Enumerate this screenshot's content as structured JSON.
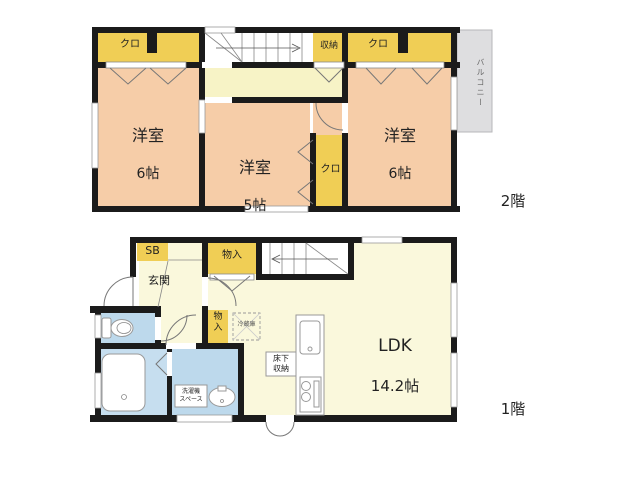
{
  "floor2": {
    "label": "2階",
    "room_left": {
      "name": "洋室",
      "size": "6帖"
    },
    "room_mid": {
      "name": "洋室",
      "size": "5帖"
    },
    "room_right": {
      "name": "洋室",
      "size": "6帖"
    },
    "closet_left": "クロ",
    "closet_mid": "クロ",
    "closet_right": "クロ",
    "storage": "収納",
    "balcony": "バルコニー"
  },
  "floor1": {
    "label": "1階",
    "ldk": {
      "name": "LDK",
      "size": "14.2帖"
    },
    "entrance": "玄関",
    "shoe_box": "SB",
    "storage_top": "物入",
    "storage_side": "物\n入",
    "fridge": "冷蔵庫",
    "underfloor_storage": "床下\n収納",
    "laundry_space": "洗濯機\nスペース"
  },
  "colors": {
    "room_peach": "#F6CDA8",
    "closet_yellow": "#F0CE55",
    "hall_cream": "#FAF8DC",
    "hall2f_cream": "#F7F3C6",
    "wet_blue": "#BDD9EC",
    "balcony_gray": "#DEDEE0",
    "wall_black": "#1B1B1B"
  }
}
